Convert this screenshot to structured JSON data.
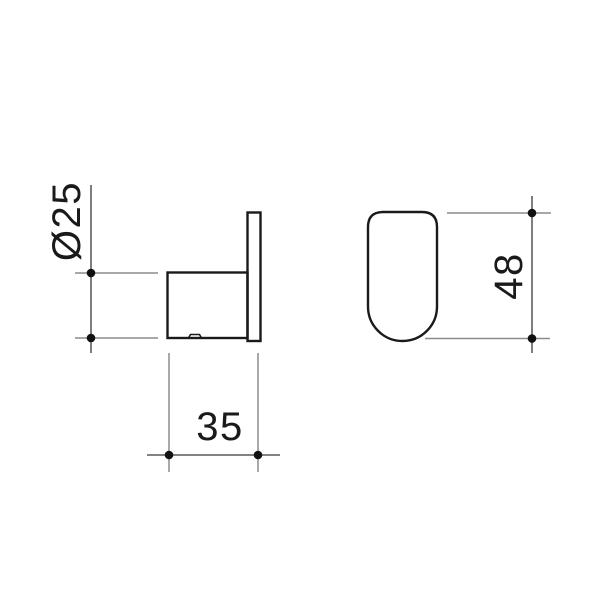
{
  "page": {
    "background": "#ffffff"
  },
  "drawing": {
    "kind": "technical-dimension-drawing",
    "views": [
      {
        "id": "side-view"
      },
      {
        "id": "front-view"
      }
    ],
    "dimensions": [
      {
        "id": "diameter",
        "label": "Ø25",
        "placement": "left-vertical"
      },
      {
        "id": "depth",
        "label": "35",
        "placement": "bottom-horizontal"
      },
      {
        "id": "height",
        "label": "48",
        "placement": "right-vertical"
      }
    ],
    "colors": {
      "outline": "#1a1a1a",
      "dimension_line": "#707070",
      "extension_line": "#8c8c8c",
      "marker_dot": "#111111",
      "text": "#1a1a1a"
    }
  }
}
